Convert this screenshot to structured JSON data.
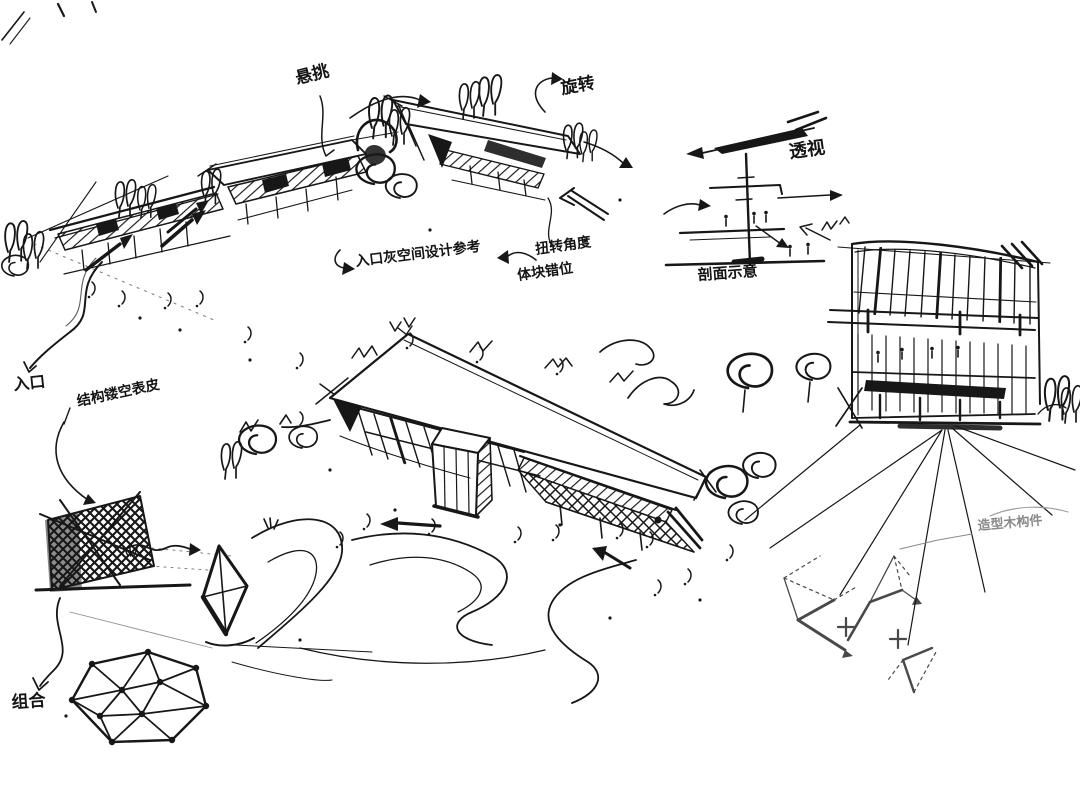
{
  "colors": {
    "ink": "#171717",
    "background": "#ffffff",
    "faint_ink": "#8a8a8a"
  },
  "annotations": {
    "cantilever": "悬挑",
    "rotation": "旋转",
    "perspective": "透视",
    "section": "剖面示意",
    "entrance": "入口",
    "entrance_note": "入口灰空间设计参考",
    "twist_angle": "扭转角度",
    "block_offset": "体块错位",
    "facade_note": "结构镂空表皮",
    "combination": "组合",
    "timber_note": "造型木构件"
  }
}
